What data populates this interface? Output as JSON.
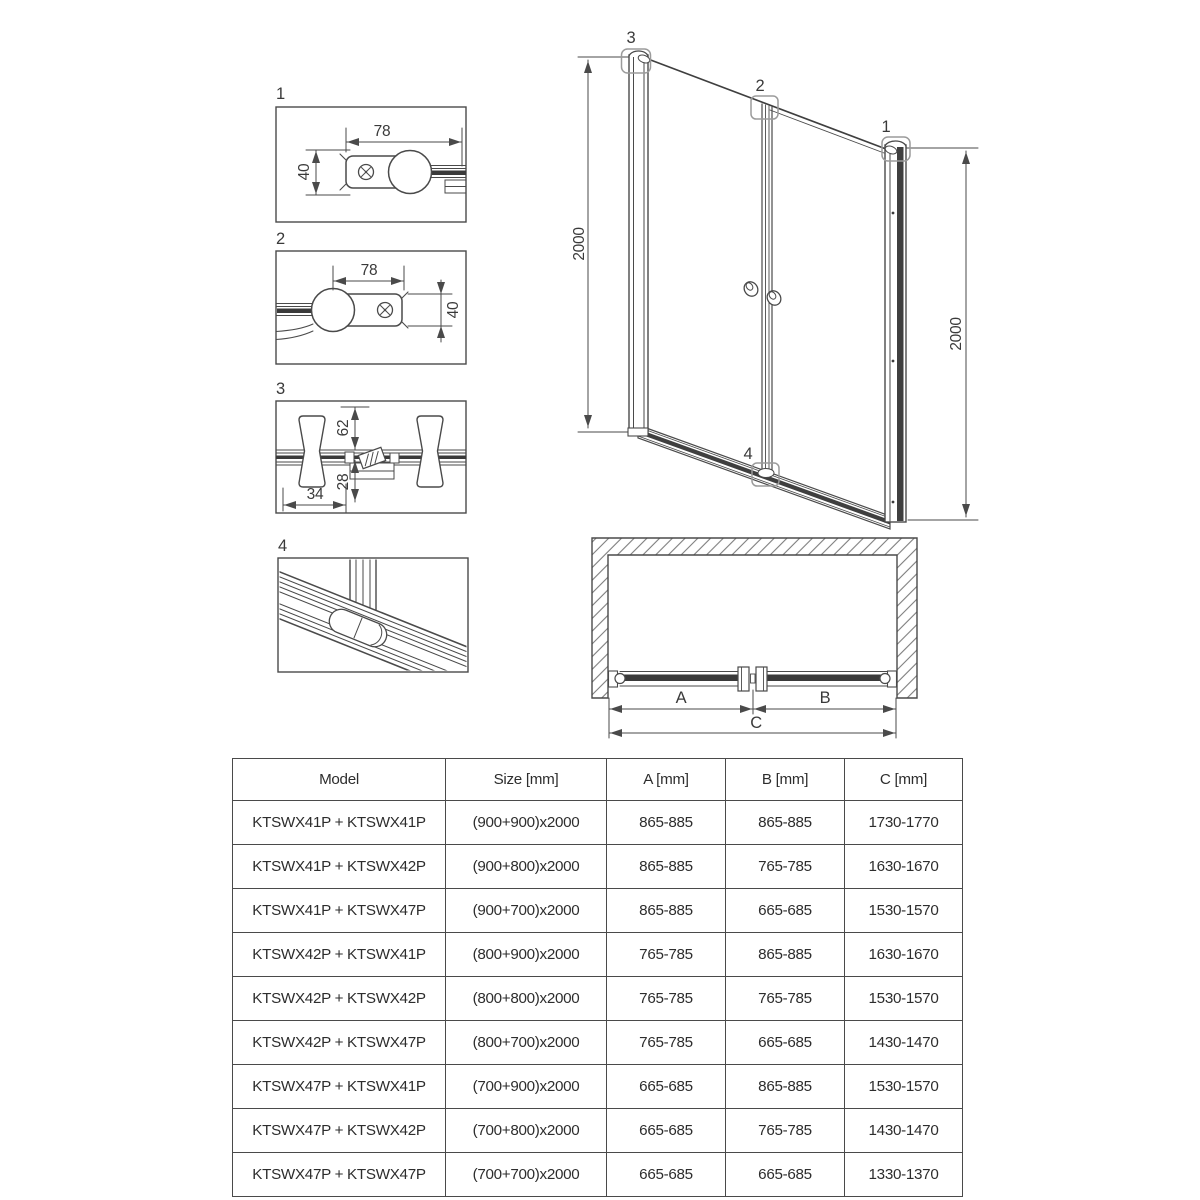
{
  "details": {
    "d1": {
      "label": "1",
      "dim_w": "78",
      "dim_h": "40"
    },
    "d2": {
      "label": "2",
      "dim_w": "78",
      "dim_h": "40"
    },
    "d3": {
      "label": "3",
      "dim_top": "62",
      "dim_bottom": "28",
      "dim_horiz": "34"
    },
    "d4": {
      "label": "4"
    }
  },
  "elevation": {
    "marker1": "1",
    "marker2": "2",
    "marker3": "3",
    "marker4": "4",
    "dim_left": "2000",
    "dim_right": "2000"
  },
  "plan": {
    "dim_a": "A",
    "dim_b": "B",
    "dim_c": "C"
  },
  "table": {
    "headers": [
      "Model",
      "Size [mm]",
      "A [mm]",
      "B [mm]",
      "C [mm]"
    ],
    "rows": [
      [
        "KTSWX41P + KTSWX41P",
        "(900+900)x2000",
        "865-885",
        "865-885",
        "1730-1770"
      ],
      [
        "KTSWX41P + KTSWX42P",
        "(900+800)x2000",
        "865-885",
        "765-785",
        "1630-1670"
      ],
      [
        "KTSWX41P + KTSWX47P",
        "(900+700)x2000",
        "865-885",
        "665-685",
        "1530-1570"
      ],
      [
        "KTSWX42P + KTSWX41P",
        "(800+900)x2000",
        "765-785",
        "865-885",
        "1630-1670"
      ],
      [
        "KTSWX42P + KTSWX42P",
        "(800+800)x2000",
        "765-785",
        "765-785",
        "1530-1570"
      ],
      [
        "KTSWX42P + KTSWX47P",
        "(800+700)x2000",
        "765-785",
        "665-685",
        "1430-1470"
      ],
      [
        "KTSWX47P + KTSWX41P",
        "(700+900)x2000",
        "665-685",
        "865-885",
        "1530-1570"
      ],
      [
        "KTSWX47P + KTSWX42P",
        "(700+800)x2000",
        "665-685",
        "765-785",
        "1430-1470"
      ],
      [
        "KTSWX47P + KTSWX47P",
        "(700+700)x2000",
        "665-685",
        "665-685",
        "1330-1370"
      ]
    ]
  },
  "colors": {
    "line": "#4a4a4a",
    "dark": "#3a3a3a",
    "callout": "#9b9b9b",
    "hatch": "#7d7d7d"
  }
}
